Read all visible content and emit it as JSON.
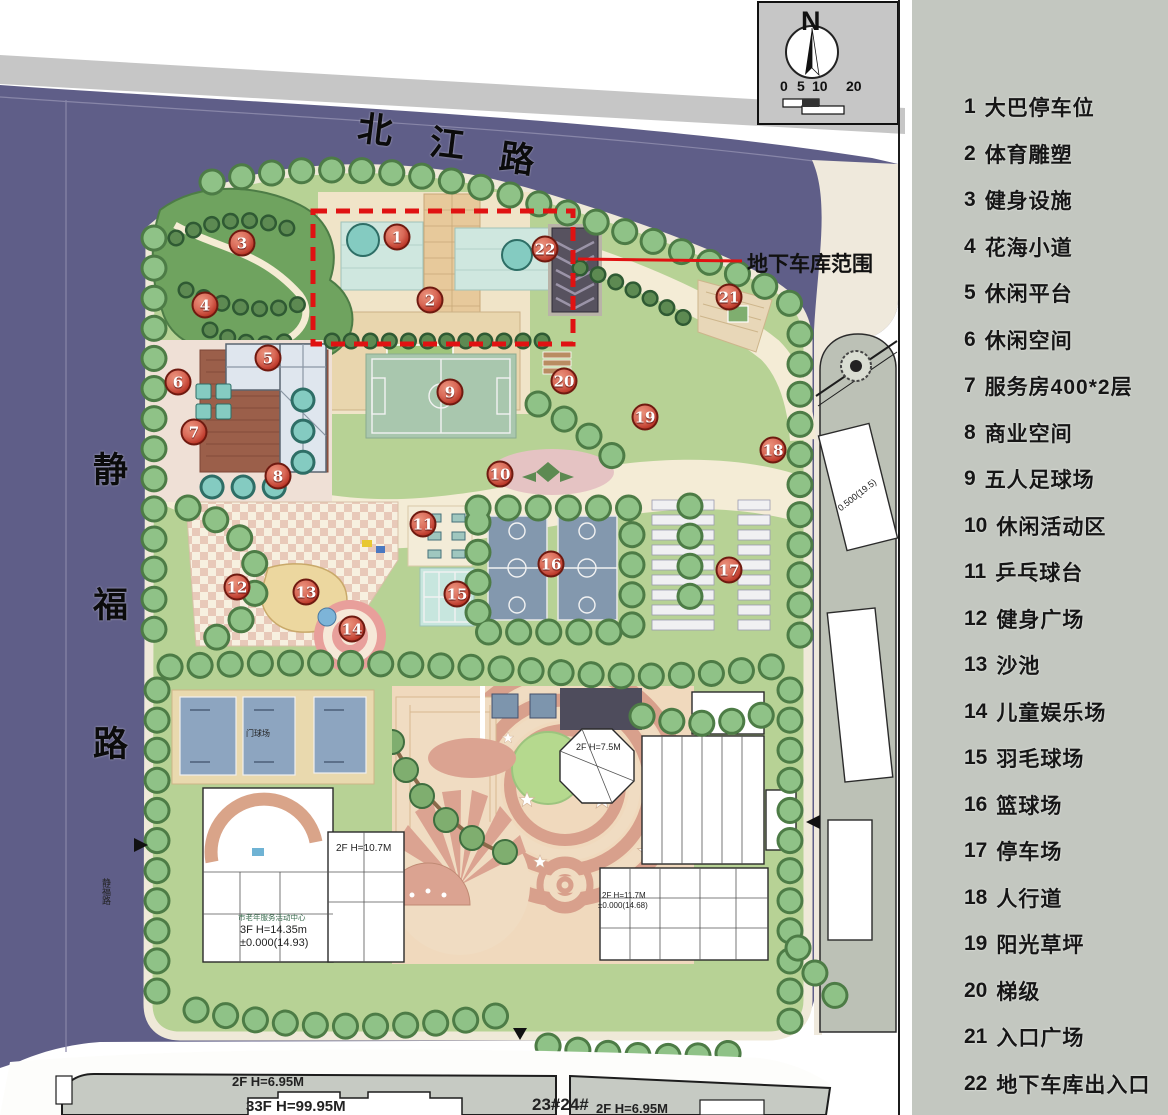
{
  "legend": {
    "items": [
      {
        "num": "1",
        "label": "大巴停车位"
      },
      {
        "num": "2",
        "label": "体育雕塑"
      },
      {
        "num": "3",
        "label": "健身设施"
      },
      {
        "num": "4",
        "label": "花海小道"
      },
      {
        "num": "5",
        "label": "休闲平台"
      },
      {
        "num": "6",
        "label": "休闲空间"
      },
      {
        "num": "7",
        "label": "服务房400*2层"
      },
      {
        "num": "8",
        "label": "商业空间"
      },
      {
        "num": "9",
        "label": "五人足球场"
      },
      {
        "num": "10",
        "label": "休闲活动区"
      },
      {
        "num": "11",
        "label": "乒乓球台"
      },
      {
        "num": "12",
        "label": "健身广场"
      },
      {
        "num": "13",
        "label": "沙池"
      },
      {
        "num": "14",
        "label": "儿童娱乐场"
      },
      {
        "num": "15",
        "label": "羽毛球场"
      },
      {
        "num": "16",
        "label": "篮球场"
      },
      {
        "num": "17",
        "label": "停车场"
      },
      {
        "num": "18",
        "label": "人行道"
      },
      {
        "num": "19",
        "label": "阳光草坪"
      },
      {
        "num": "20",
        "label": "梯级"
      },
      {
        "num": "21",
        "label": "入口广场"
      },
      {
        "num": "22",
        "label": "地下车库出入口"
      }
    ]
  },
  "roads": {
    "north": [
      "北",
      "江",
      "路"
    ],
    "west": [
      "静",
      "福",
      "路"
    ],
    "west_small": "静福路"
  },
  "compass": {
    "north_letter": "N",
    "scale_ticks": [
      "0",
      "5",
      "10",
      "20"
    ]
  },
  "annotations": {
    "garage_range": "地下车库范围"
  },
  "building_labels": {
    "octagon": "2F H=7.5M",
    "mid_building": "2F H=10.7M",
    "center_caption": "市老年服务活动中心",
    "center_height": "3F H=14.35m",
    "center_elev": "±0.000(14.93)",
    "school_height": "2F H=11.7M",
    "school_elev": "±0.000(14.68)",
    "gateball": "门球场",
    "east_elev": "0.500(19.5)",
    "sw_parcel_h": "2F H=6.95M",
    "sw_parcel_tower": "33F H=99.95M",
    "s_parcel_no": "23#24#",
    "s_parcel_h": "2F H=6.95M"
  },
  "plan_markers": [
    {
      "n": "1",
      "x": 397,
      "y": 237
    },
    {
      "n": "2",
      "x": 430,
      "y": 300
    },
    {
      "n": "3",
      "x": 242,
      "y": 243
    },
    {
      "n": "4",
      "x": 205,
      "y": 305
    },
    {
      "n": "5",
      "x": 268,
      "y": 358
    },
    {
      "n": "6",
      "x": 178,
      "y": 382
    },
    {
      "n": "7",
      "x": 194,
      "y": 432
    },
    {
      "n": "8",
      "x": 278,
      "y": 476
    },
    {
      "n": "9",
      "x": 450,
      "y": 392
    },
    {
      "n": "10",
      "x": 500,
      "y": 474
    },
    {
      "n": "11",
      "x": 423,
      "y": 524
    },
    {
      "n": "12",
      "x": 237,
      "y": 587
    },
    {
      "n": "13",
      "x": 306,
      "y": 592
    },
    {
      "n": "14",
      "x": 352,
      "y": 629
    },
    {
      "n": "15",
      "x": 457,
      "y": 594
    },
    {
      "n": "16",
      "x": 551,
      "y": 564
    },
    {
      "n": "17",
      "x": 729,
      "y": 570
    },
    {
      "n": "18",
      "x": 773,
      "y": 450
    },
    {
      "n": "19",
      "x": 645,
      "y": 417
    },
    {
      "n": "20",
      "x": 564,
      "y": 381
    },
    {
      "n": "21",
      "x": 729,
      "y": 297
    },
    {
      "n": "22",
      "x": 545,
      "y": 249
    }
  ]
}
